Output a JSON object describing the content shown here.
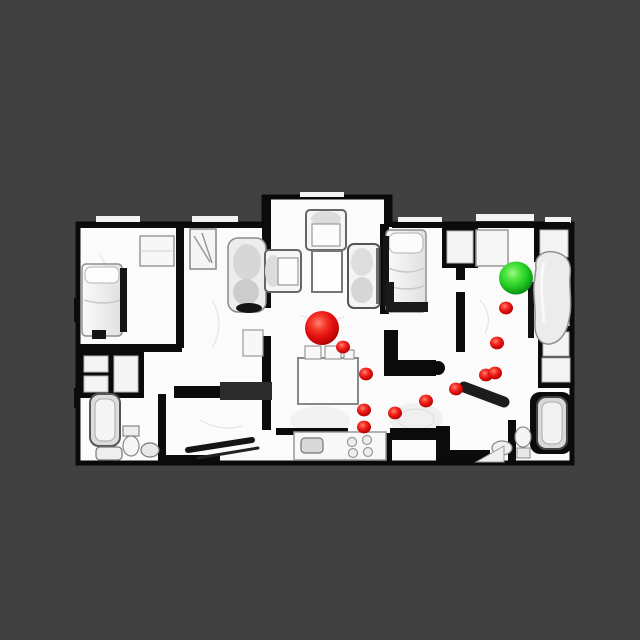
{
  "scene": {
    "type": "top-down-orthographic-render-of-3d-scanned-apartment",
    "background_color": "#414141",
    "floor_color": "#fbfbfb",
    "wall_color": "#0b0b0b",
    "furniture_fill": "#f2f2f2",
    "furniture_stroke": "#8f8f8f",
    "canvas": {
      "width": 640,
      "height": 640
    }
  },
  "markers": {
    "agent": {
      "x": 322,
      "y": 328,
      "rx": 17,
      "ry": 17,
      "color": "#e01111",
      "label": "large-red-sphere"
    },
    "goal": {
      "x": 516,
      "y": 278,
      "rx": 17,
      "ry": 16.5,
      "color": "#2fcb2f",
      "label": "green-sphere"
    },
    "waypoint_color": "#e01111",
    "waypoint_rx": 7,
    "waypoint_ry": 6.4,
    "waypoints": [
      {
        "x": 343,
        "y": 347
      },
      {
        "x": 366,
        "y": 374
      },
      {
        "x": 364,
        "y": 410
      },
      {
        "x": 364,
        "y": 427
      },
      {
        "x": 395,
        "y": 413
      },
      {
        "x": 426,
        "y": 401
      },
      {
        "x": 456,
        "y": 389
      },
      {
        "x": 486,
        "y": 375
      },
      {
        "x": 495,
        "y": 373
      },
      {
        "x": 497,
        "y": 343
      },
      {
        "x": 506,
        "y": 308
      }
    ]
  },
  "visible_objects": [
    "bed-left-bedroom",
    "dresser-left-bedroom",
    "armchair-second-room",
    "closet-second-room",
    "armchair-top-living",
    "armchair-left-living",
    "coffee-table",
    "loveseat-living",
    "dining-table",
    "dining-chairs",
    "kitchen-counter",
    "kitchen-sink",
    "stove-burners",
    "bed-mid-right-bedroom",
    "bed-right-bedroom",
    "dresser-right-bedroom",
    "bathtub-left",
    "toilet-left",
    "sink-left",
    "bathtub-right",
    "toilet-right",
    "sink-right"
  ]
}
